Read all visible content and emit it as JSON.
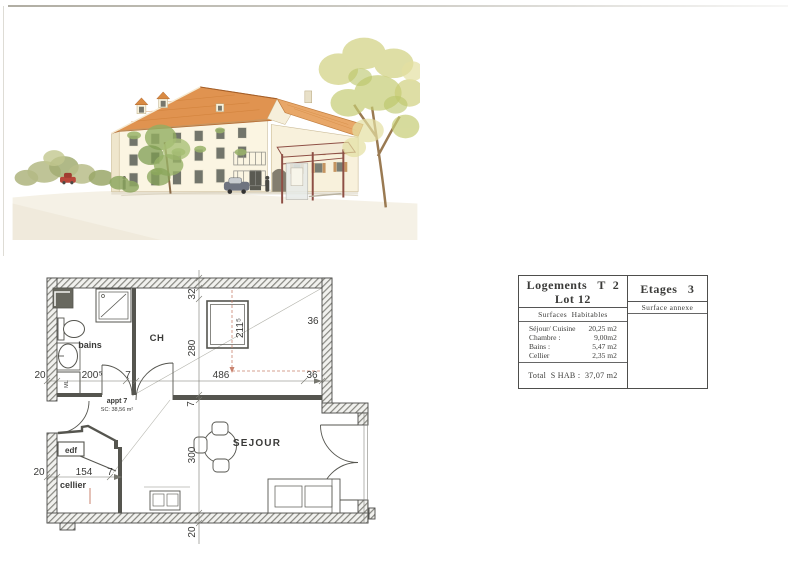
{
  "illustration": {
    "type": "watercolor-elevation-sketch",
    "palette": {
      "roof": "#e09350",
      "roof_rear": "#e8a768",
      "facade": "#fbf5e2",
      "shutter": "#c08a52",
      "foliage_green": "#97b266",
      "foliage_autumn": "#d3d388",
      "shelter_frame": "#8e4f45",
      "street": "#f5f1e6",
      "car_red": "#b8473a",
      "car_gray": "#6f7480"
    }
  },
  "floor_plan": {
    "apartment_label": "appt  7",
    "apartment_area": "SC: 38,56 m²",
    "rooms": {
      "bedroom": "CH",
      "bathroom": "bains",
      "living": "SEJOUR",
      "cellar": "cellier",
      "utility": "edf",
      "washer": "ML"
    },
    "dimensions": {
      "left_wall_top": "20",
      "bains_width": "200⁵",
      "hall_wall": "7",
      "ch_width": "486",
      "right_wall_upper": "36",
      "right_wall_lower": "36",
      "top_offset": "32",
      "ch_depth": "280",
      "window_dim": "211⁵",
      "mid_wall": "7",
      "sejour_depth": "300",
      "bottom_wall": "20",
      "left_wall_bottom": "20",
      "cellier_width": "154",
      "cellier_wall": "7"
    },
    "colors": {
      "wall_line": "#4a4a48",
      "dashed_red": "#c9836f"
    }
  },
  "summary_table": {
    "title_line1": "Logements   T  2",
    "title_line2": "Lot 12",
    "floors_label": "Etages   3",
    "col1_header": "Surfaces  Habitables",
    "col2_header": "Surface annexe",
    "rows": [
      {
        "label": "Séjour/ Cuisine",
        "value": "20,25 m2"
      },
      {
        "label": "Chambre :",
        "value": "9,00m2"
      },
      {
        "label": "Bains :",
        "value": "5,47 m2"
      },
      {
        "label": "Cellier",
        "value": "2,35 m2"
      }
    ],
    "total": "Total  S HAB :  37,07 m2"
  }
}
